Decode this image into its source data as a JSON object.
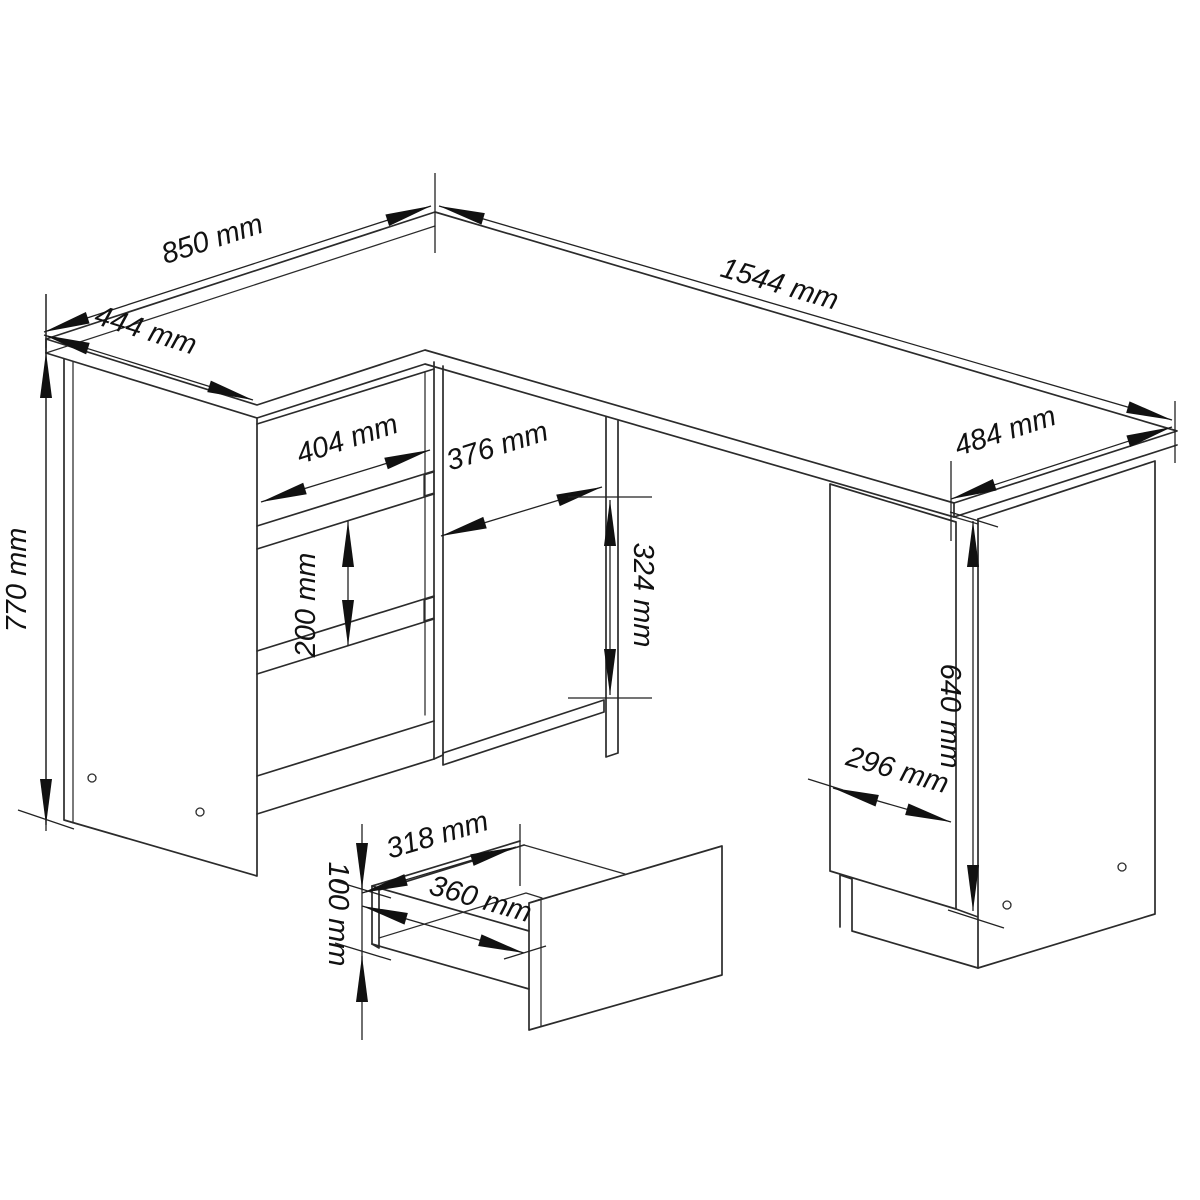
{
  "page": {
    "background_color": "#ffffff"
  },
  "style": {
    "line_color": "#2b2b2b",
    "arrow_color": "#111111",
    "text_color": "#111111",
    "unit": "mm"
  },
  "dimensions": {
    "desk_depth_850": {
      "label": "850 mm",
      "value": 850
    },
    "left_top_width_444": {
      "label": "444 mm",
      "value": 444
    },
    "desk_length_1544": {
      "label": "1544 mm",
      "value": 1544
    },
    "right_top_depth_484": {
      "label": "484 mm",
      "value": 484
    },
    "desk_height_770": {
      "label": "770 mm",
      "value": 770
    },
    "drawer_front_width_404": {
      "label": "404 mm",
      "value": 404
    },
    "shelf_opening_width_376": {
      "label": "376 mm",
      "value": 376
    },
    "shelf_opening_height_324": {
      "label": "324 mm",
      "value": 324
    },
    "drawer_pitch_200": {
      "label": "200 mm",
      "value": 200
    },
    "cabinet_height_640": {
      "label": "640 mm",
      "value": 640
    },
    "cabinet_width_296": {
      "label": "296 mm",
      "value": 296
    },
    "drawer_inner_width_318": {
      "label": "318 mm",
      "value": 318
    },
    "drawer_outer_width_360": {
      "label": "360 mm",
      "value": 360
    },
    "drawer_height_100": {
      "label": "100 mm",
      "value": 100
    }
  }
}
